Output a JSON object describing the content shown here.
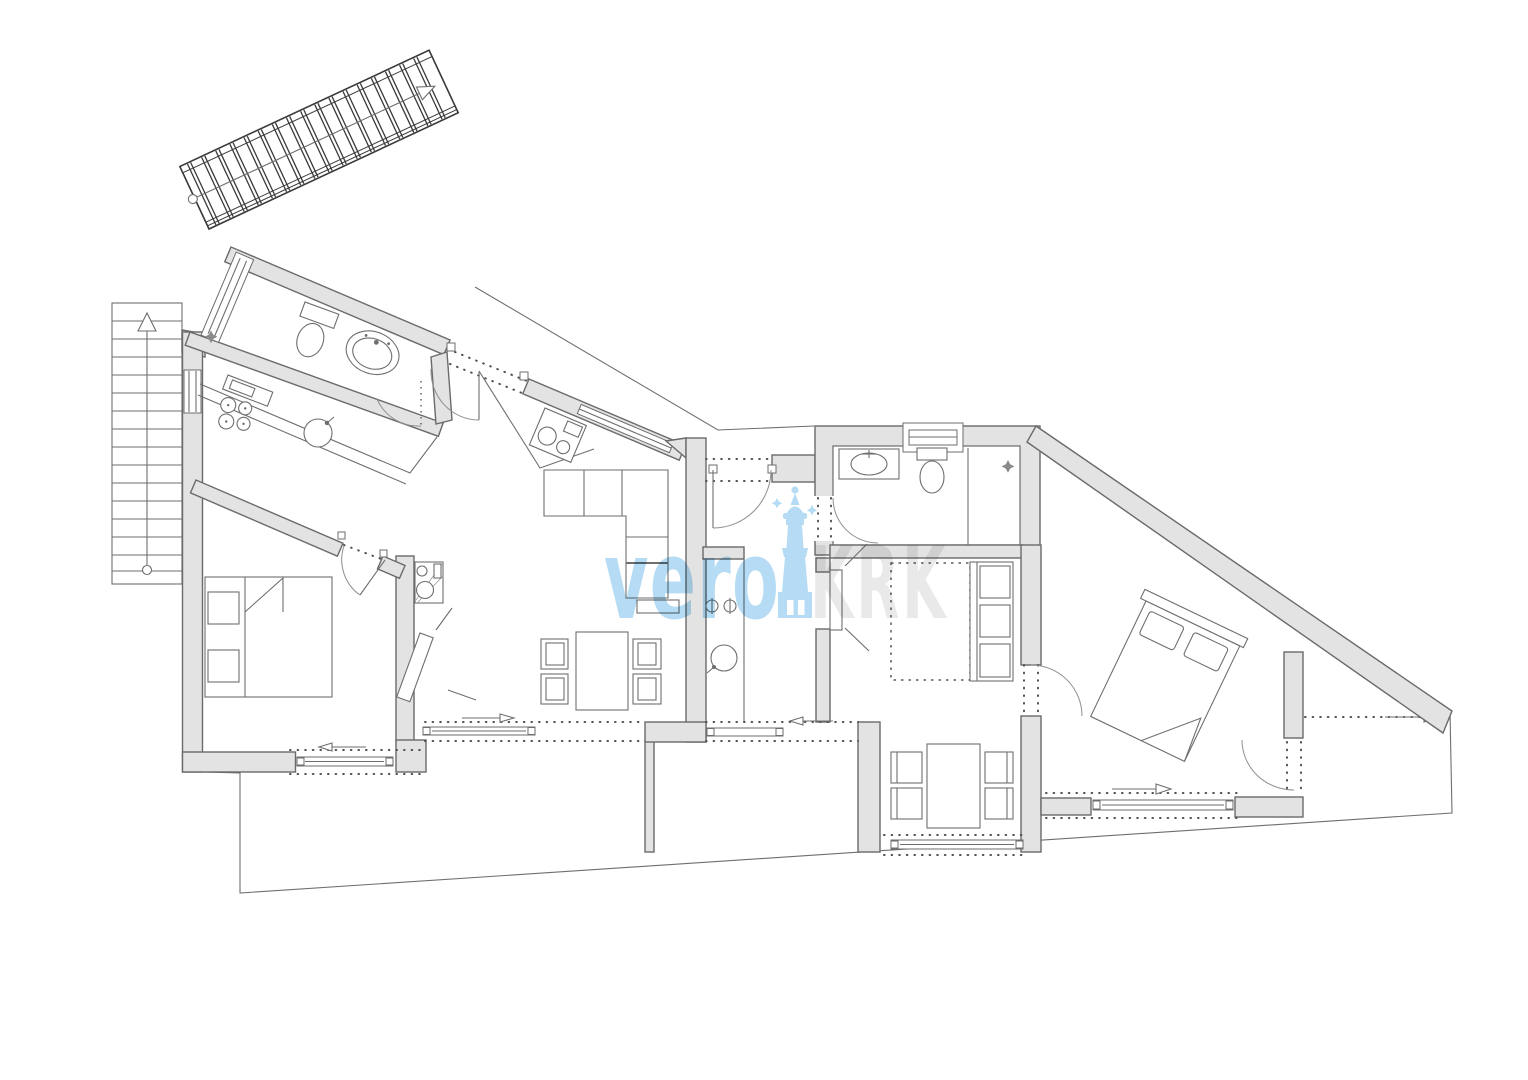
{
  "watermark": {
    "brand": "vero",
    "island": "KRK",
    "brand_color": "#b5dcf4",
    "island_color": "#e9e9e9",
    "tower_icon": "lighthouse-tower-icon"
  },
  "palette": {
    "wall_fill": "#e3e3e3",
    "wall_stroke": "#6a6a6a",
    "line": "#6e6e6e",
    "dots": "#4f4f4f",
    "door_arc": "#8f8f8f",
    "background": "#ffffff"
  }
}
